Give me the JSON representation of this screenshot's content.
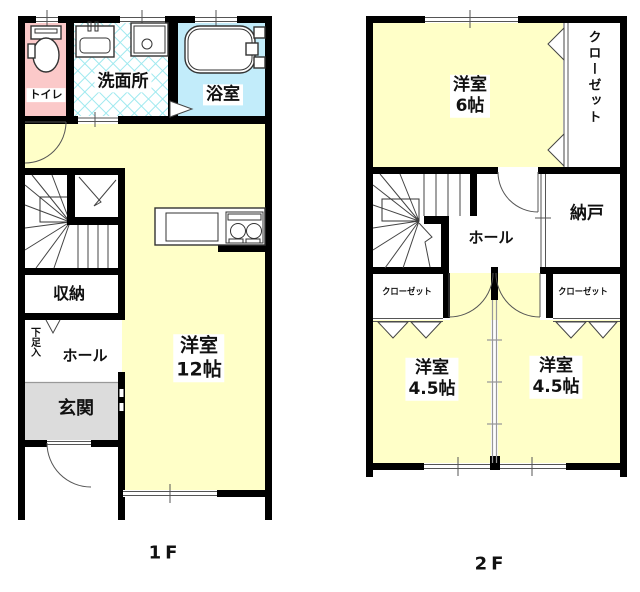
{
  "floor1": {
    "floor_label": "1F",
    "rooms": {
      "toilet": "トイレ",
      "washroom": "洗面所",
      "bathroom": "浴室",
      "storage": "収納",
      "shoe_cabinet": "下足入",
      "hall": "ホール",
      "entrance": "玄関",
      "living_name": "洋室",
      "living_size": "12帖"
    }
  },
  "floor2": {
    "floor_label": "2F",
    "rooms": {
      "bedroom6_name": "洋室",
      "bedroom6_size": "6帖",
      "closet_main": "クローゼット",
      "hall": "ホール",
      "storeroom": "納戸",
      "closet_left": "クローゼット",
      "closet_right": "クローゼット",
      "bedroom_left_name": "洋室",
      "bedroom_left_size": "4.5帖",
      "bedroom_right_name": "洋室",
      "bedroom_right_size": "4.5帖"
    }
  },
  "colors": {
    "room_yellow": "#FFFFC8",
    "toilet_pink": "#FBC9C9",
    "bath_blue": "#C2ECFA",
    "tile_cyan": "#9FE9EF",
    "entrance_gray": "#DCDCDC",
    "wall_black": "#000000"
  }
}
